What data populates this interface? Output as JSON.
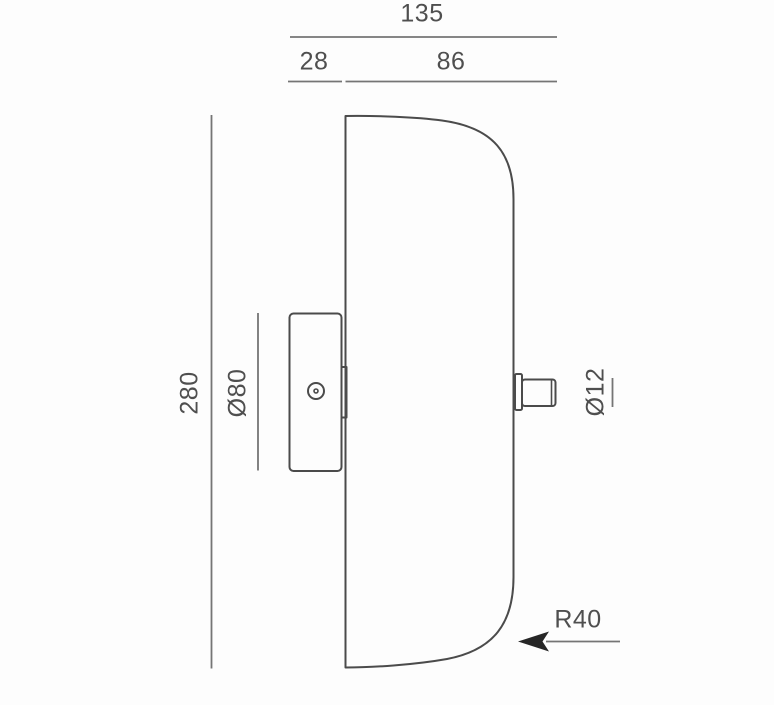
{
  "drawing": {
    "type": "technical-dimension-drawing",
    "view": "wall-lamp-side-profile",
    "dimensions": {
      "overall_depth": "135",
      "backplate_depth": "28",
      "shade_depth": "86",
      "overall_height": "280",
      "backplate_diameter": "Ø80",
      "stem_diameter": "Ø12",
      "corner_radius": "R40"
    },
    "colors": {
      "background": "#fdfdfd",
      "outline": "#4b4b4b",
      "dimension_line": "#757575",
      "label_text": "#4f4f4f",
      "arrow": "#262626"
    }
  }
}
